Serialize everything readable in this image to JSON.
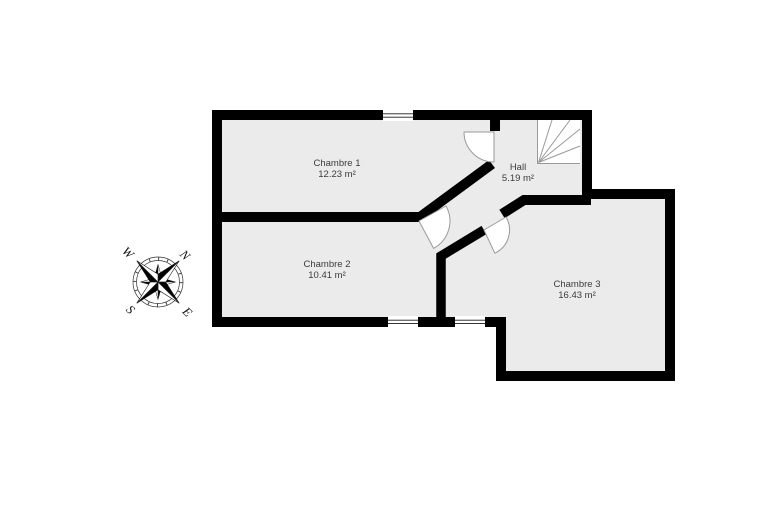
{
  "plan": {
    "type": "floor-plan",
    "rooms": [
      {
        "name": "Chambre 1",
        "area": "12.23 m²"
      },
      {
        "name": "Hall",
        "area": "5.19 m²"
      },
      {
        "name": "Chambre 2",
        "area": "10.41 m²"
      },
      {
        "name": "Chambre 3",
        "area": "16.43 m²"
      }
    ],
    "window_count": 3,
    "door_count": 3,
    "has_staircase": true
  },
  "compass": {
    "n": "N",
    "e": "E",
    "s": "S",
    "w": "W"
  },
  "colors": {
    "background": "#ffffff",
    "wall": "#000000",
    "floor": "#ebebeb",
    "door_arc": "#9a9a9a",
    "stair_line": "#9a9a9a",
    "label_text": "#3c3c3c"
  }
}
